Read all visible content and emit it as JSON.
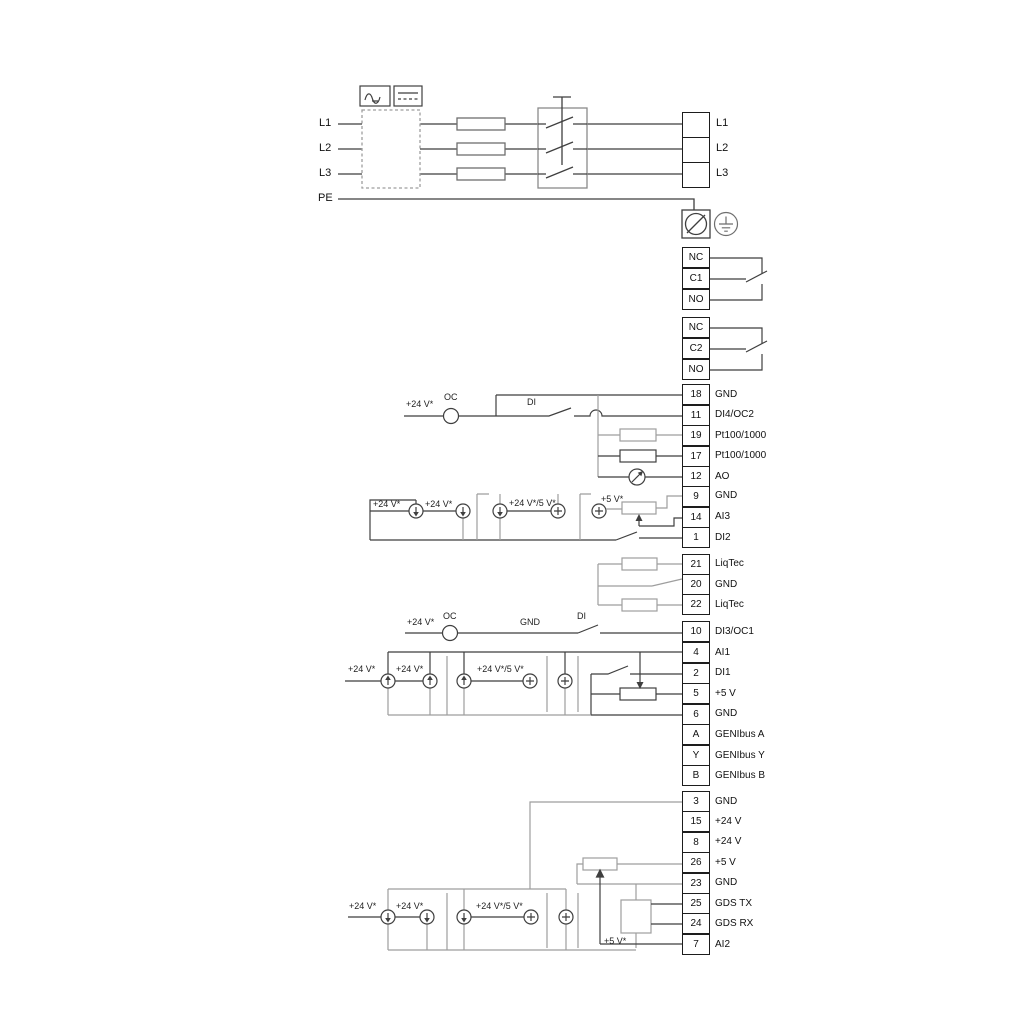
{
  "power": {
    "in": [
      "L1",
      "L2",
      "L3",
      "PE"
    ],
    "out": [
      "L1",
      "L2",
      "L3"
    ]
  },
  "relays": {
    "r1": [
      "NC",
      "C1",
      "NO"
    ],
    "r2": [
      "NC",
      "C2",
      "NO"
    ]
  },
  "terminals": [
    {
      "number": "18",
      "label": "GND"
    },
    {
      "number": "11",
      "label": "DI4/OC2"
    },
    {
      "number": "19",
      "label": "Pt100/1000"
    },
    {
      "number": "17",
      "label": "Pt100/1000"
    },
    {
      "number": "12",
      "label": "AO"
    },
    {
      "number": "9",
      "label": "GND"
    },
    {
      "number": "14",
      "label": "AI3"
    },
    {
      "number": "1",
      "label": "DI2"
    },
    {
      "number": "21",
      "label": "LiqTec"
    },
    {
      "number": "20",
      "label": "GND"
    },
    {
      "number": "22",
      "label": "LiqTec"
    },
    {
      "number": "10",
      "label": "DI3/OC1"
    },
    {
      "number": "4",
      "label": "AI1"
    },
    {
      "number": "2",
      "label": "DI1"
    },
    {
      "number": "5",
      "label": "+5 V"
    },
    {
      "number": "6",
      "label": "GND"
    },
    {
      "number": "A",
      "label": "GENIbus A"
    },
    {
      "number": "Y",
      "label": "GENIbus Y"
    },
    {
      "number": "B",
      "label": "GENIbus B"
    },
    {
      "number": "3",
      "label": "GND"
    },
    {
      "number": "15",
      "label": "+24 V"
    },
    {
      "number": "8",
      "label": "+24 V"
    },
    {
      "number": "26",
      "label": "+5 V"
    },
    {
      "number": "23",
      "label": "GND"
    },
    {
      "number": "25",
      "label": "GDS TX"
    },
    {
      "number": "24",
      "label": "GDS RX"
    },
    {
      "number": "7",
      "label": "AI2"
    }
  ],
  "labels": {
    "plus24": "+24 V*",
    "plus24or5": "+24 V*/5 V*",
    "plus5": "+5 V*",
    "oc": "OC",
    "di": "DI",
    "gnd": "GND"
  },
  "colors": {
    "line_dark": "#3f3f3f",
    "line_grey": "#9e9e9e"
  }
}
